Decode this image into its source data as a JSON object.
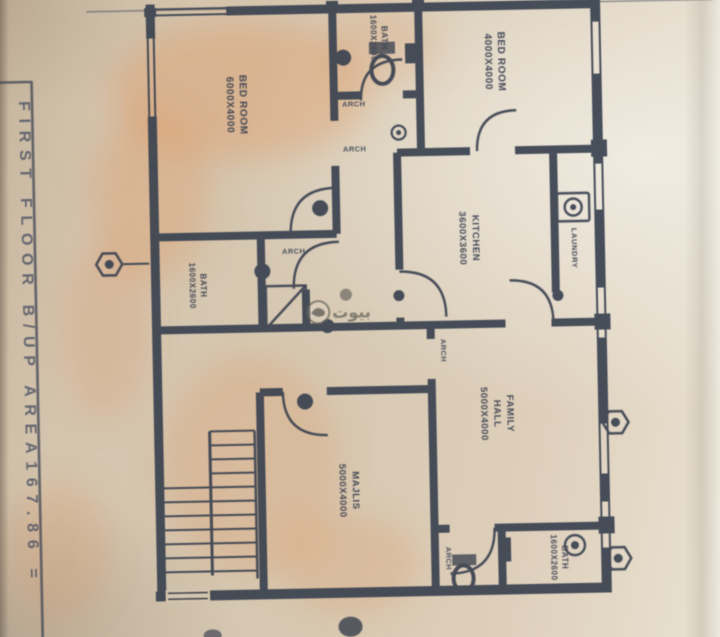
{
  "sheet": {
    "title": "FIRST FLOOR B/UP AREA167.86 ="
  },
  "rooms": {
    "bedroom_left": {
      "line1": "BED ROOM",
      "line2": "6000X4000"
    },
    "bath_top": {
      "line1": "BATH",
      "line2": "1600X2600"
    },
    "bedroom_right": {
      "line1": "BED ROOM",
      "line2": "4000X4000"
    },
    "kitchen": {
      "line1": "KITCHEN",
      "line2": "3600X3600"
    },
    "laundry": {
      "line1": "LAUNDRY"
    },
    "bath_left": {
      "line1": "BATH",
      "line2": "1600X2600"
    },
    "family_hall": {
      "line1": "FAMILY",
      "line2": "HALL",
      "line3": "5000X4000"
    },
    "majlis": {
      "line1": "MAJLIS",
      "line2": "5000X4000"
    },
    "bath_bottom": {
      "line1": "BATH",
      "line2": "1600X2600"
    }
  },
  "annotations": {
    "arch_top": "ARCH",
    "arch_mid": "ARCH",
    "arch_lobby": "ARCH",
    "arch_family": "ARCH",
    "arch_wc": "ARCH"
  },
  "watermark": {
    "brand_arabic": "بيوت"
  },
  "colors": {
    "paper": "#d6c8b2",
    "paper_light": "#e7e2d4",
    "ink": "#3b4150",
    "orange_watermark": "#e0874a"
  }
}
